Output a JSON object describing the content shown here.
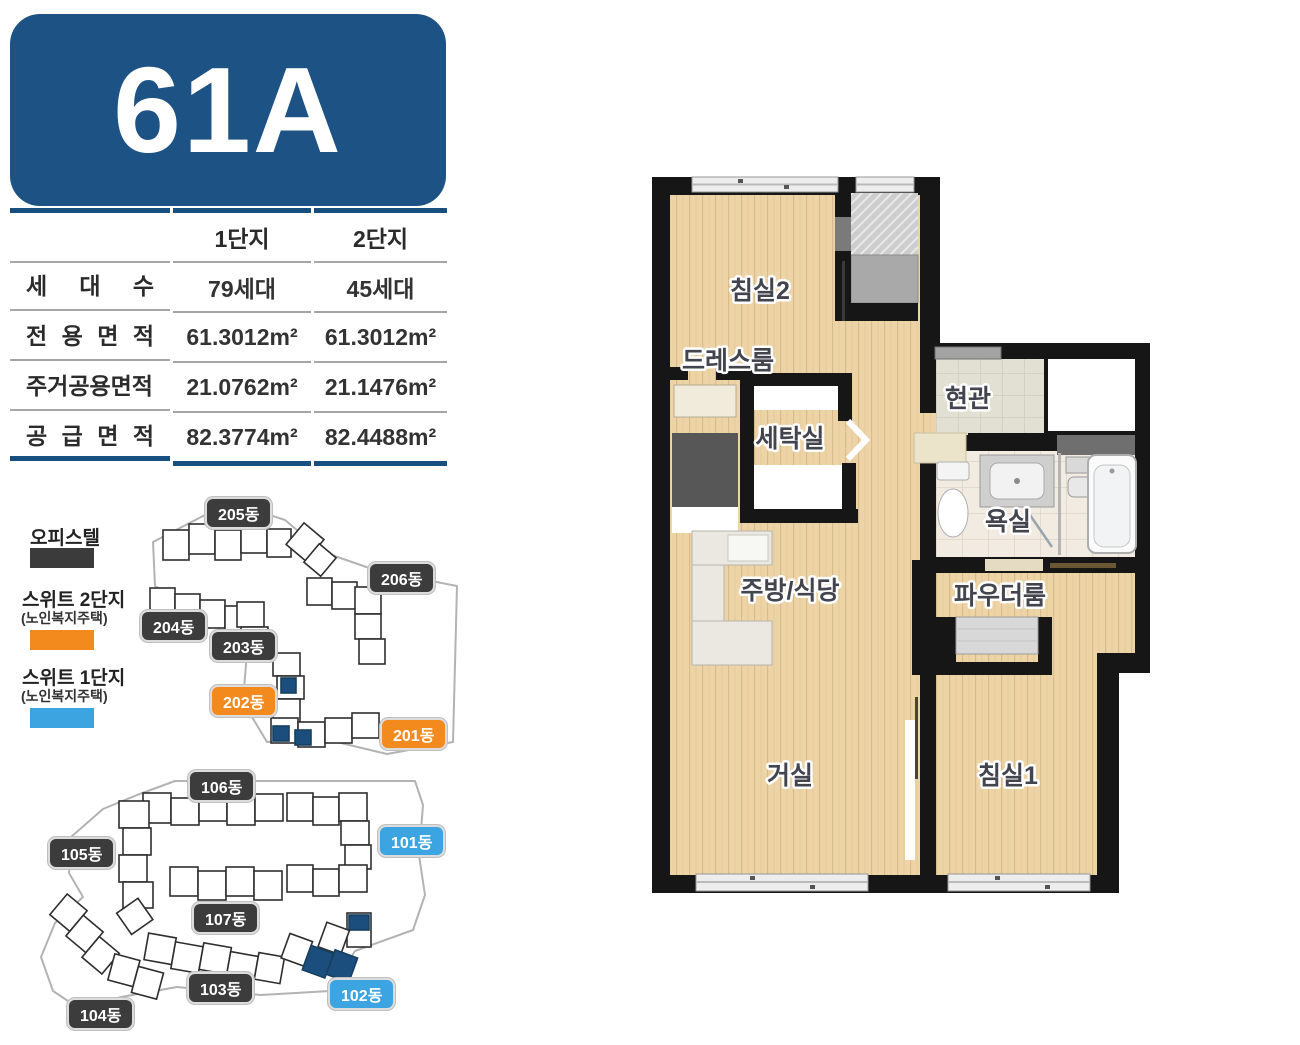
{
  "unit": {
    "title": "61A"
  },
  "colors": {
    "primary_blue": "#1d5284",
    "table_line_navy": "#17507f",
    "badge_dark": "#3c3c3c",
    "badge_orange": "#f28a1d",
    "badge_sky_blue": "#3ca4e0",
    "highlight_navy": "#1b4d7d",
    "wood_floor": "#edd4a7",
    "wall_black": "#161616"
  },
  "spec_table": {
    "columns": [
      "1단지",
      "2단지"
    ],
    "rows": [
      {
        "label": "세 대 수",
        "complex1": "79세대",
        "complex2": "45세대"
      },
      {
        "label": "전 용 면 적",
        "complex1": "61.3012m²",
        "complex2": "61.3012m²"
      },
      {
        "label": "주거공용면적",
        "complex1": "21.0762m²",
        "complex2": "21.1476m²"
      },
      {
        "label": "공 급 면 적",
        "complex1": "82.3774m²",
        "complex2": "82.4488m²"
      }
    ]
  },
  "legend": {
    "items": [
      {
        "label": "오피스텔",
        "sublabel": "",
        "swatch": "#3b3b3b"
      },
      {
        "label": "스위트 2단지",
        "sublabel": "(노인복지주택)",
        "swatch": "#f28a1d"
      },
      {
        "label": "스위트 1단지",
        "sublabel": "(노인복지주택)",
        "swatch": "#3ca4e0"
      }
    ]
  },
  "site_map_upper": {
    "badges": [
      {
        "label": "205동",
        "type": "dark"
      },
      {
        "label": "206동",
        "type": "dark"
      },
      {
        "label": "204동",
        "type": "dark"
      },
      {
        "label": "203동",
        "type": "dark"
      },
      {
        "label": "202동",
        "type": "orange"
      },
      {
        "label": "201동",
        "type": "orange"
      }
    ]
  },
  "site_map_lower": {
    "badges": [
      {
        "label": "106동",
        "type": "dark"
      },
      {
        "label": "101동",
        "type": "blue"
      },
      {
        "label": "105동",
        "type": "dark"
      },
      {
        "label": "107동",
        "type": "dark"
      },
      {
        "label": "103동",
        "type": "dark"
      },
      {
        "label": "102동",
        "type": "blue"
      },
      {
        "label": "104동",
        "type": "dark"
      }
    ]
  },
  "floor_plan": {
    "rooms": [
      {
        "name": "침실2"
      },
      {
        "name": "드레스룸"
      },
      {
        "name": "세탁실"
      },
      {
        "name": "현관"
      },
      {
        "name": "욕실"
      },
      {
        "name": "주방/식당"
      },
      {
        "name": "파우더룸"
      },
      {
        "name": "거실"
      },
      {
        "name": "침실1"
      }
    ]
  }
}
